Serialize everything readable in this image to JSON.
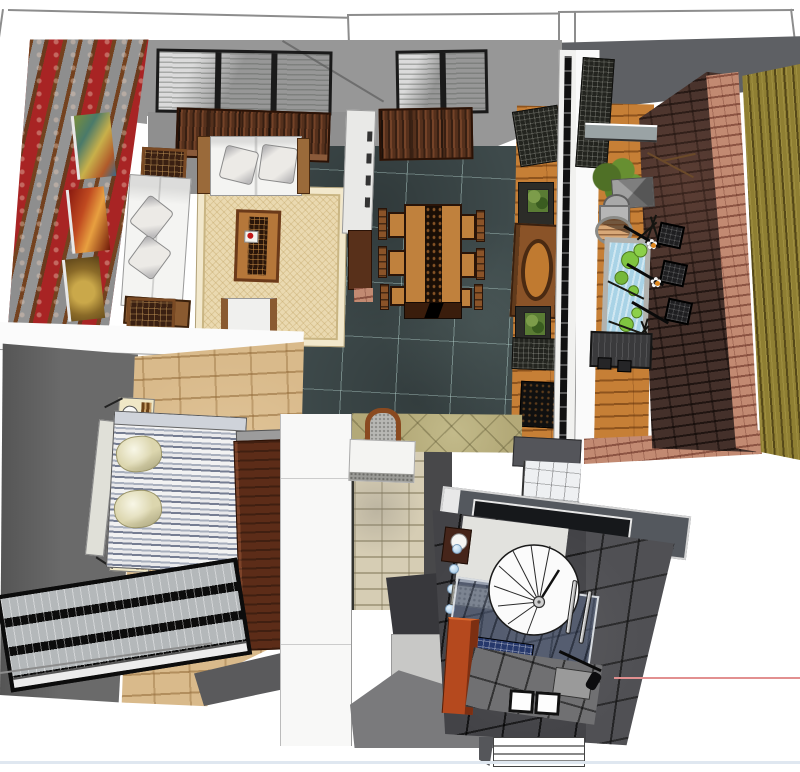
{
  "scene": {
    "title": "apartment-3d-top-down-render",
    "view": "bird's-eye perspective of a furnished apartment model",
    "background_color": "#ffffff",
    "axis_line_color": "#e29090",
    "ground_edge_color": "#dfe7f0"
  },
  "glyphs": {
    "flower": "✿"
  },
  "palette": {
    "ceiling_gray": "#979797",
    "balcony_roof_gray": "#5e6064",
    "teal_tile_floor": "#3e4a4b",
    "red_wallpaper": "#a82424",
    "wall_band_gray": "#8e8e8e",
    "wood_slat_brown": "#74421f",
    "rug_cream": "#ead9b0",
    "sofa_white": "#f4f4f2",
    "dining_wood": "#c0813d",
    "dark_cabinet_wood": "#55301c",
    "corridor_deck_wood": "#c67f36",
    "privacy_brick_dark": "#44302a",
    "brick_pink": "#c28a72",
    "bamboo_fence": "#8f7f33",
    "pond_water": "#a9d3e6",
    "lily_pad_green": "#7fc440",
    "bedroom_wall_gray": "#6a6a6a",
    "bedroom_stone_floor": "#d9ba8b",
    "wardrobe_wood": "#5c2c18",
    "bathroom_tile_dark": "#434347",
    "bathroom_cabinet_orange": "#b5491e",
    "mosaic_blue": "#26386b",
    "entry_brick_beige": "#d6cdb4"
  },
  "rooms": [
    {
      "id": "living-room",
      "objects": [
        "red-damask-feature-wall",
        "three-paintings",
        "skylight-window",
        "wall-cabinets",
        "l-shaped-white-sofa",
        "throw-pillows",
        "carved-side-cabinets",
        "coffee-table-with-tea-set",
        "cream-area-rug",
        "armchair"
      ]
    },
    {
      "id": "dining-room",
      "objects": [
        "teal-tile-floor",
        "white-divider-cabinet",
        "skylight-window",
        "wall-cabinet",
        "wood-dining-table-with-carved-runner",
        "six-chairs",
        "bench"
      ]
    },
    {
      "id": "entry-corridor",
      "objects": [
        "wood-plank-floor",
        "lattice-screens",
        "moon-gate-partition",
        "plant-console-tables",
        "black-doormat"
      ]
    },
    {
      "id": "balcony",
      "objects": [
        "glass-partition-wall",
        "wood-deck",
        "potted-tree",
        "stone-parasol-table",
        "planter-pots",
        "drum-stool",
        "lily-pond",
        "standing-lattice-lamps",
        "white-daisies",
        "dark-brick-privacy-wall",
        "pink-brick-pillar",
        "bamboo-fence"
      ]
    },
    {
      "id": "bedroom",
      "objects": [
        "gray-walls",
        "stone-tile-floor",
        "double-bed-striped-duvet",
        "headboard",
        "two-pillows",
        "two-nightstands-with-lamps",
        "wardrobe",
        "large-black-framed-window"
      ]
    },
    {
      "id": "hallway",
      "objects": [
        "white-partition-wall",
        "beige-brick-wall",
        "flagstone-floor",
        "arched-mirror",
        "white-counter",
        "entry-step",
        "light-tile-floor"
      ]
    },
    {
      "id": "bathroom",
      "objects": [
        "glass-roof-panel",
        "dark-tile-shell",
        "vanity-with-round-sink",
        "blue-glass-balls",
        "spiral-shower-screen",
        "glass-shower-floor",
        "blue-mosaic-strip",
        "orange-cabinet",
        "gray-floor-tiles",
        "two-white-mats",
        "chrome-door-handles",
        "hand-sprayer",
        "white-steps"
      ]
    }
  ]
}
